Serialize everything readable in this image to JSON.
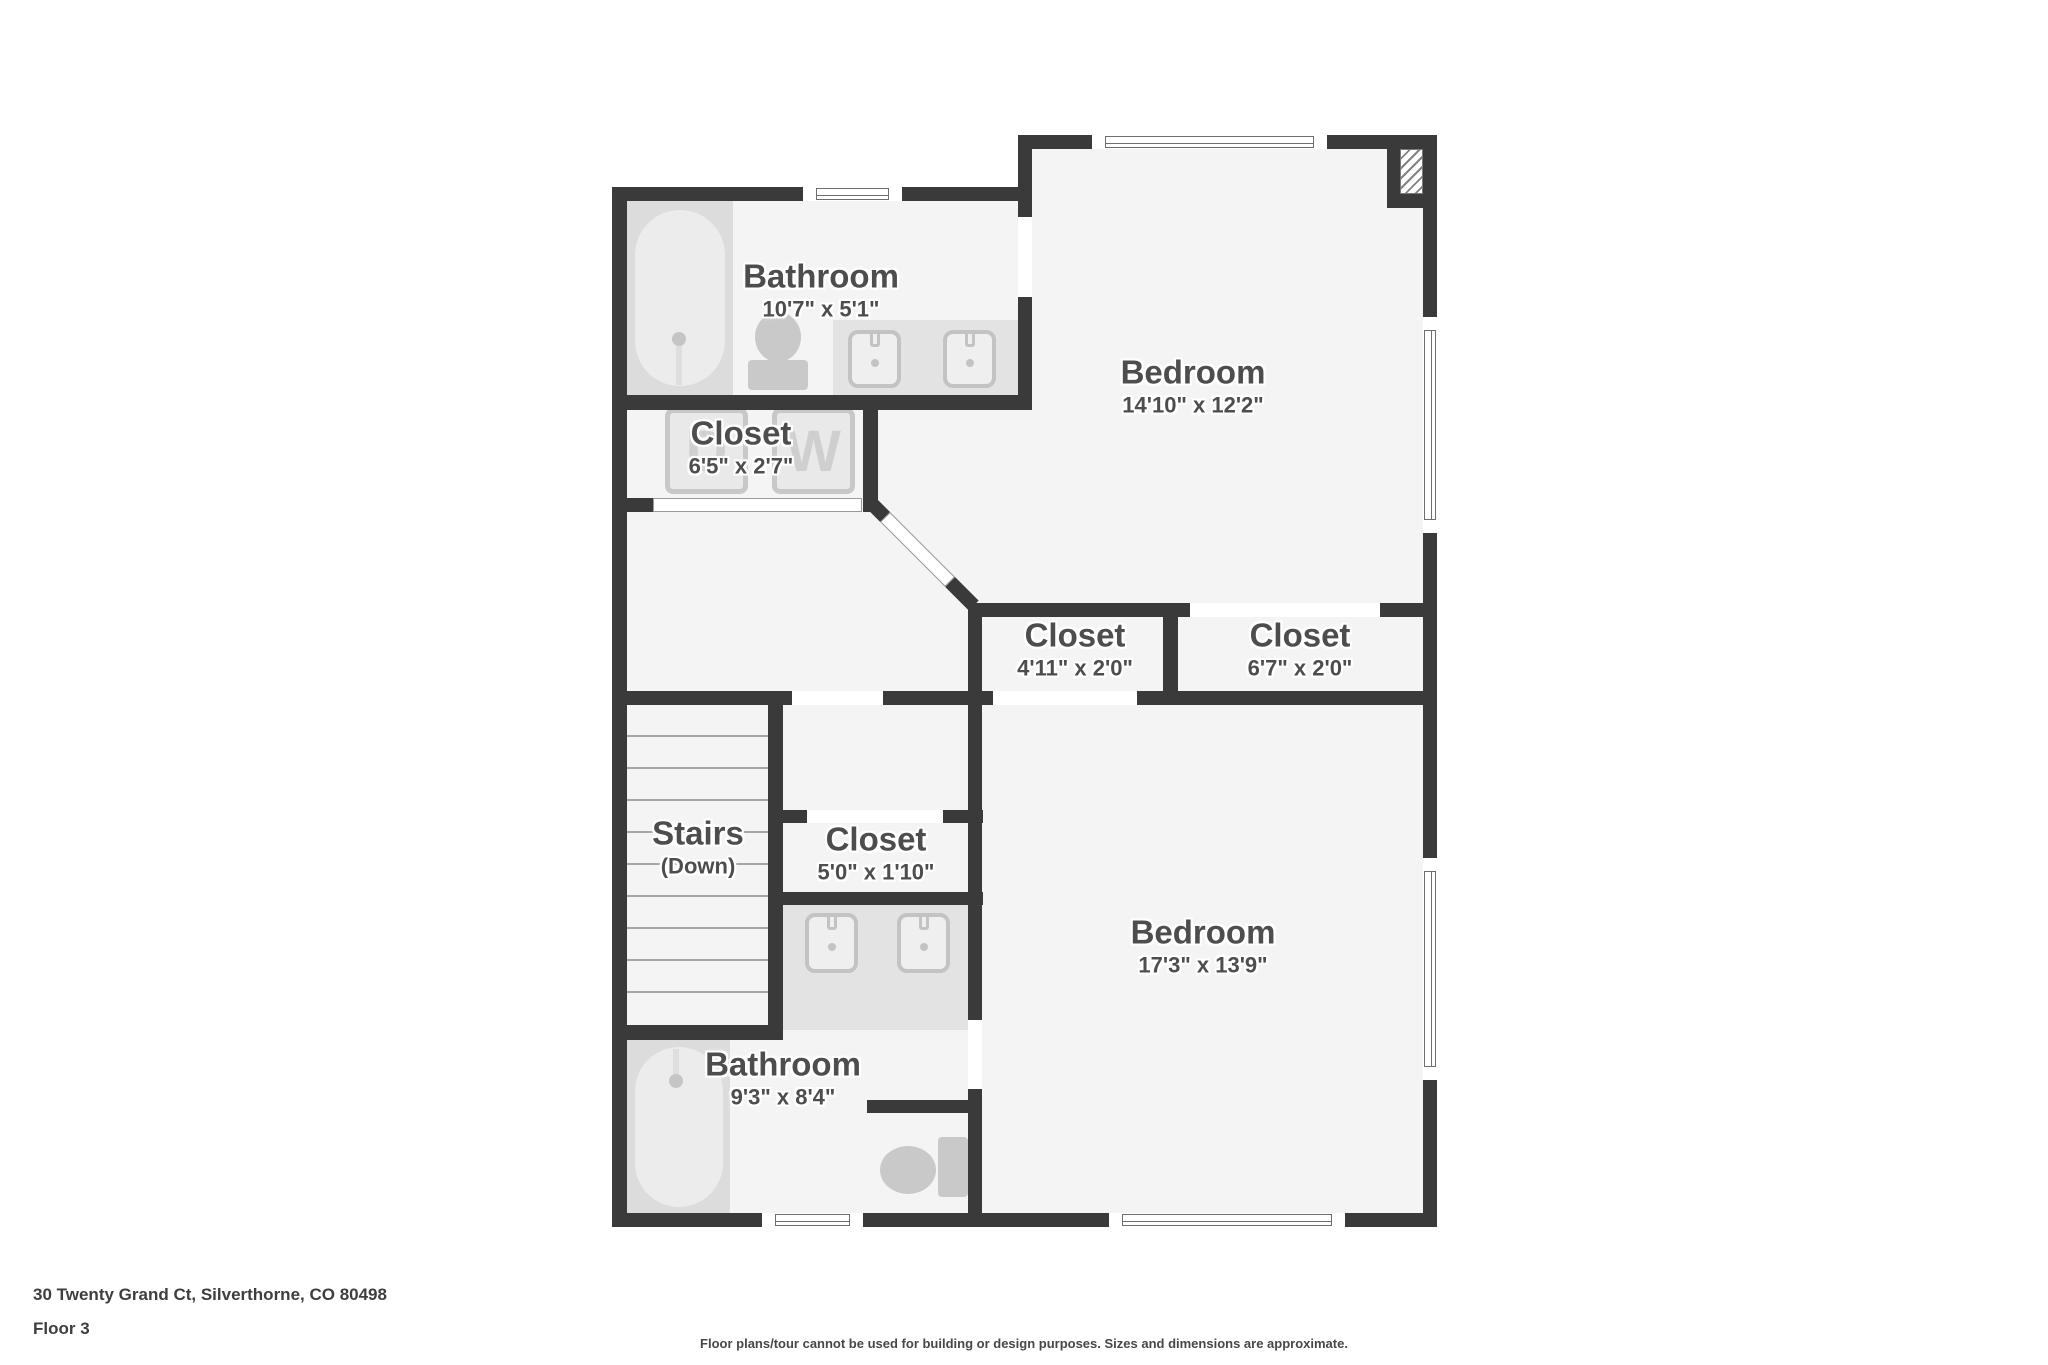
{
  "colors": {
    "wall": "#3a3a3a",
    "floor": "#f4f4f4",
    "fixture": "#c9c9c9",
    "label_text": "#4d4d4d"
  },
  "rooms": [
    {
      "name": "Bathroom",
      "dims": "10'7\" x 5'1\""
    },
    {
      "name": "Closet",
      "dims": "6'5\" x 2'7\""
    },
    {
      "name": "Bedroom",
      "dims": "14'10\" x 12'2\""
    },
    {
      "name": "Closet",
      "dims": "4'11\" x 2'0\""
    },
    {
      "name": "Closet",
      "dims": "6'7\" x 2'0\""
    },
    {
      "name": "Stairs",
      "dims": "(Down)"
    },
    {
      "name": "Closet",
      "dims": "5'0\" x 1'10\""
    },
    {
      "name": "Bedroom",
      "dims": "17'3\" x 13'9\""
    },
    {
      "name": "Bathroom",
      "dims": "9'3\" x 8'4\""
    }
  ],
  "appliances": {
    "dryer_label": "D",
    "washer_label": "W"
  },
  "footer": {
    "address": "30 Twenty Grand Ct, Silverthorne, CO 80498",
    "floor_label": "Floor 3",
    "disclaimer": "Floor plans/tour cannot be used for building or design purposes. Sizes and dimensions are approximate."
  }
}
